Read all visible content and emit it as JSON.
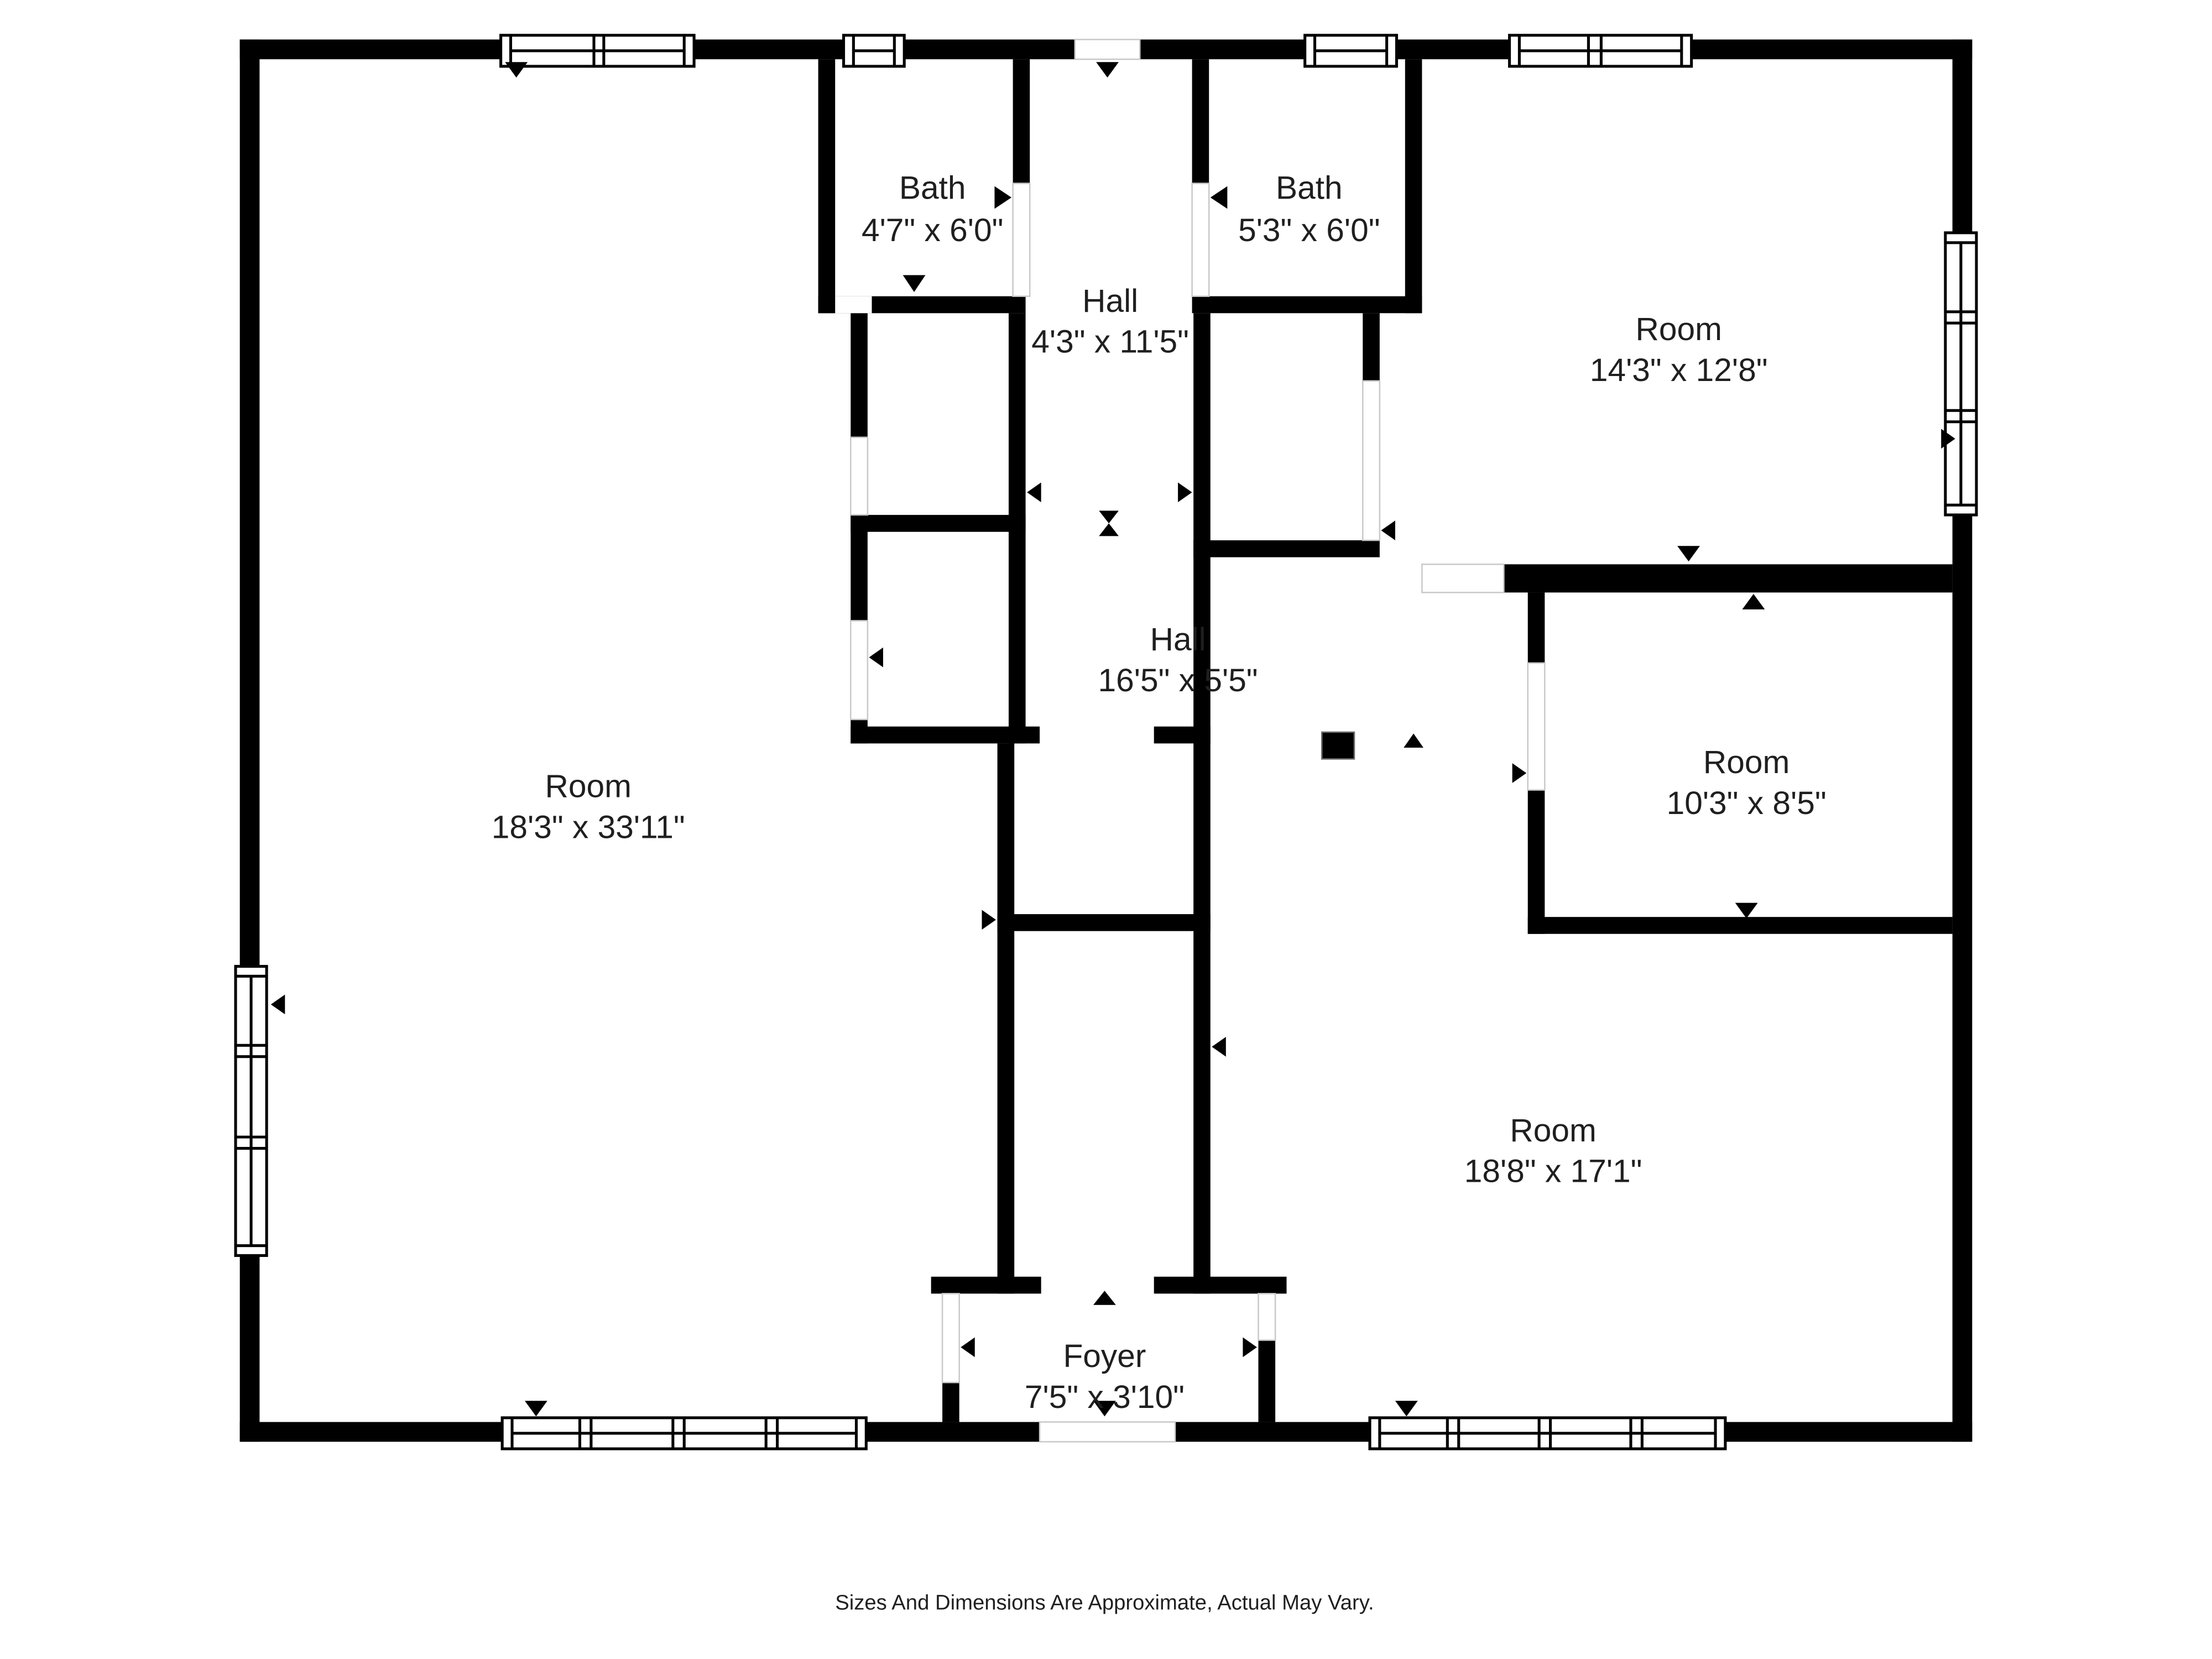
{
  "page": {
    "background_color": "#ffffff",
    "wall_color": "#000000",
    "text_color": "#1f1f1f"
  },
  "rooms": [
    {
      "name": "Bath",
      "dims": "4'7\" x 6'0\""
    },
    {
      "name": "Bath",
      "dims": "5'3\" x 6'0\""
    },
    {
      "name": "Hall",
      "dims": "4'3\" x 11'5\""
    },
    {
      "name": "Room",
      "dims": "14'3\" x 12'8\""
    },
    {
      "name": "Hall",
      "dims": "16'5\" x 5'5\""
    },
    {
      "name": "Room",
      "dims": "18'3\" x 33'11\""
    },
    {
      "name": "Room",
      "dims": "10'3\" x 8'5\""
    },
    {
      "name": "Room",
      "dims": "18'8\" x 17'1\""
    },
    {
      "name": "Foyer",
      "dims": "7'5\" x 3'10\""
    }
  ],
  "footer": {
    "disclaimer": "Sizes And Dimensions Are Approximate, Actual May Vary."
  }
}
